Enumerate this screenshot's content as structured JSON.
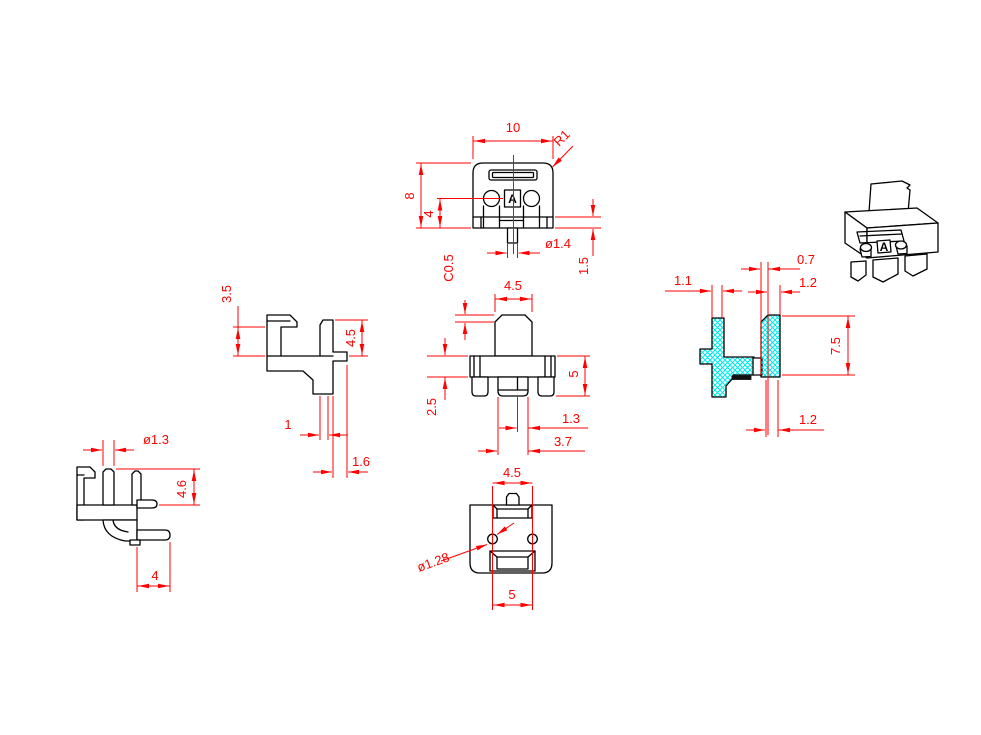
{
  "drawing": {
    "background": "#ffffff",
    "line_color": "#000000",
    "dim_color": "#ff0000",
    "hatch_color": "#00e8e8",
    "views": {
      "front": {
        "dim_width": "10",
        "dim_radius": "R1",
        "dim_height": "8",
        "dim_step": "4",
        "dim_pin_dia": "ø1.4",
        "dim_pin_len": "1.5",
        "datum": "A"
      },
      "side": {
        "dim_hook": "3.5",
        "dim_post": "4.5",
        "dim_leg_w": "1",
        "dim_leg_off": "1.6"
      },
      "rear": {
        "dim_chamfer": "C0.5",
        "dim_post_w": "4.5",
        "dim_height": "5",
        "dim_leg_h": "2.5",
        "dim_pin_w": "1.3",
        "dim_leg_span": "3.7"
      },
      "section": {
        "dim_wall": "1.1",
        "dim_gap": "0.7",
        "dim_rib_top": "1.2",
        "dim_height": "7.5",
        "dim_rib_bottom": "1.2"
      },
      "side_lower": {
        "dim_pin_dia": "ø1.3",
        "dim_height": "4.6",
        "dim_pin_len": "4"
      },
      "bottom": {
        "dim_slot": "4.5",
        "dim_hole": "ø1.28",
        "dim_pitch": "5"
      },
      "isometric": {
        "datum": "A"
      }
    }
  }
}
